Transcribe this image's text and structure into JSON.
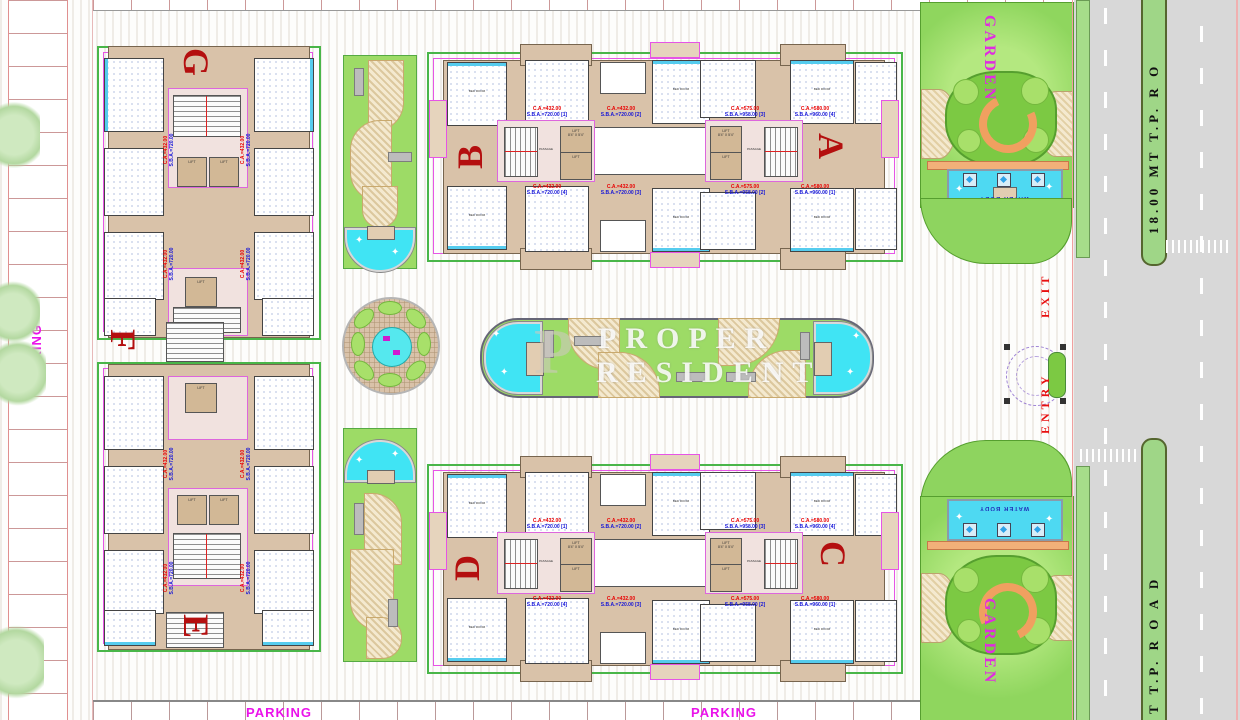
{
  "watermark": {
    "logo": "P",
    "line1": "PROPER",
    "line2": "RESIDENT"
  },
  "buildings": {
    "a": "A",
    "b": "B",
    "c": "C",
    "d": "D",
    "e": "E",
    "f": "F",
    "g": "G"
  },
  "labels": {
    "parking": "PARKING",
    "garden": "GARDEN",
    "water_body": "WATER BODY",
    "entry": "ENTRY",
    "exit": "EXIT",
    "entry_gate": "ENTRY GATE",
    "road_median_top": "18.00 MT  T.P.  R  O",
    "road_median_bottom": "T  T.P.  R  O  A  D",
    "lift": "LIFT",
    "lift_size": "8'4\" X 5'4\"",
    "passage": "PASSAGE",
    "bed_room": "BED ROOM",
    "living_room": "LIVING ROOM"
  },
  "apartments": {
    "type_b": {
      "ca": "C.A.=432.00",
      "sba": "S.B.A.=720.00"
    },
    "type_a1": {
      "ca": "C.A.=575.00",
      "sba": "S.B.A.=958.00"
    },
    "type_a2": {
      "ca": "C.A.=580.00",
      "sba": "S.B.A.=960.00"
    },
    "units": {
      "u1": "[1]",
      "u2": "[2]",
      "u3": "[3]",
      "u4": "[4]"
    }
  },
  "colors": {
    "building_letter": "#b40f0f",
    "annotation_red": "#e80000",
    "annotation_blue": "#1414d8",
    "parking_magenta": "#ea12ea",
    "garden_green": "#8fd65e",
    "water_cyan": "#4ed9f2",
    "room_tan": "#d9c2a9",
    "road_gray": "#d8d8d8",
    "median_green": "#9fd687"
  }
}
